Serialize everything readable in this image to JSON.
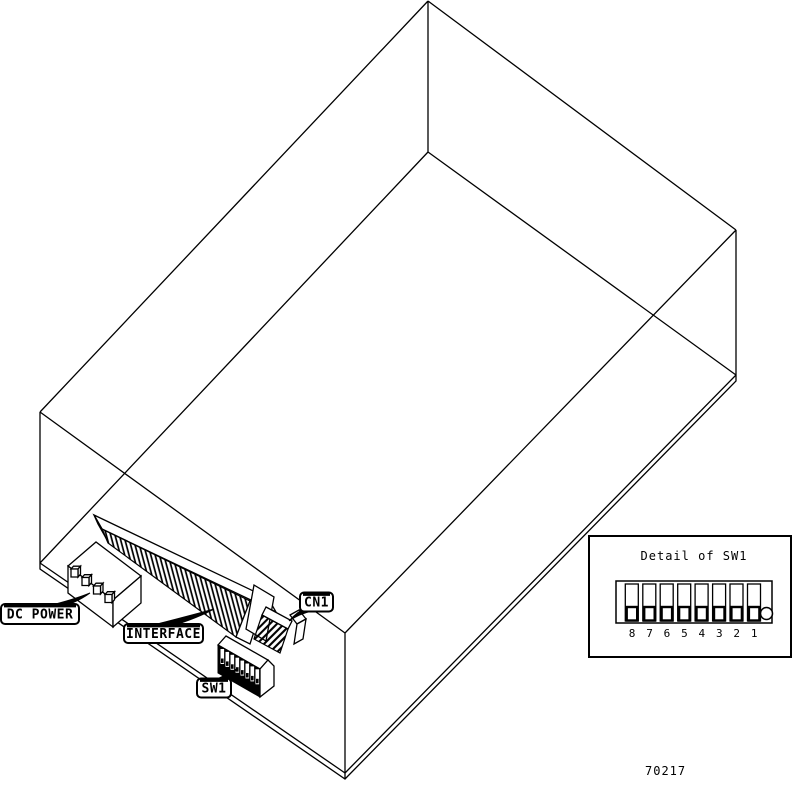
{
  "diagram": {
    "callouts": {
      "dc_power": "DC POWER",
      "interface": "INTERFACE",
      "cn1": "CN1",
      "sw1": "SW1"
    },
    "inset": {
      "title": "Detail of SW1",
      "switch_numbers": [
        "8",
        "7",
        "6",
        "5",
        "4",
        "3",
        "2",
        "1"
      ]
    },
    "figure_number": "70217",
    "colors": {
      "line": "#000000",
      "background": "#ffffff"
    }
  }
}
